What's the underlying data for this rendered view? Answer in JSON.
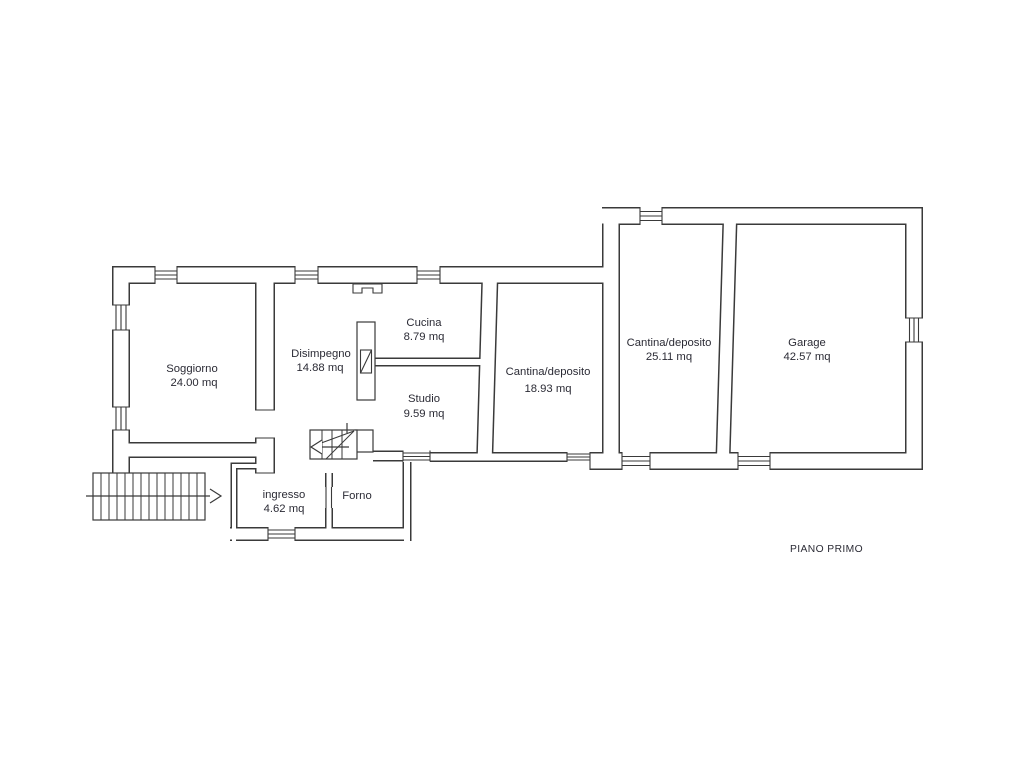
{
  "floor_plan": {
    "title": "PIANO PRIMO",
    "rooms": [
      {
        "id": "soggiorno",
        "name": "Soggiorno",
        "area": "24.00 mq"
      },
      {
        "id": "disimpegno",
        "name": "Disimpegno",
        "area": "14.88 mq"
      },
      {
        "id": "cucina",
        "name": "Cucina",
        "area": "8.79 mq"
      },
      {
        "id": "studio",
        "name": "Studio",
        "area": "9.59 mq"
      },
      {
        "id": "cantina-1",
        "name": "Cantina/deposito",
        "area": "18.93 mq"
      },
      {
        "id": "cantina-2",
        "name": "Cantina/deposito",
        "area": "25.11 mq"
      },
      {
        "id": "garage",
        "name": "Garage",
        "area": "42.57 mq"
      },
      {
        "id": "ingresso",
        "name": "ingresso",
        "area": "4.62 mq"
      },
      {
        "id": "forno",
        "name": "Forno",
        "area": ""
      }
    ],
    "symbols": [
      "external-staircase-icon",
      "winder-staircase-icon",
      "direction-arrow-icon",
      "window-symbol",
      "door-symbol",
      "flue-symbol",
      "chimney-symbol"
    ],
    "colors": {
      "line": "#3a3a3a",
      "text": "#2b2b35",
      "background": "#ffffff"
    }
  }
}
